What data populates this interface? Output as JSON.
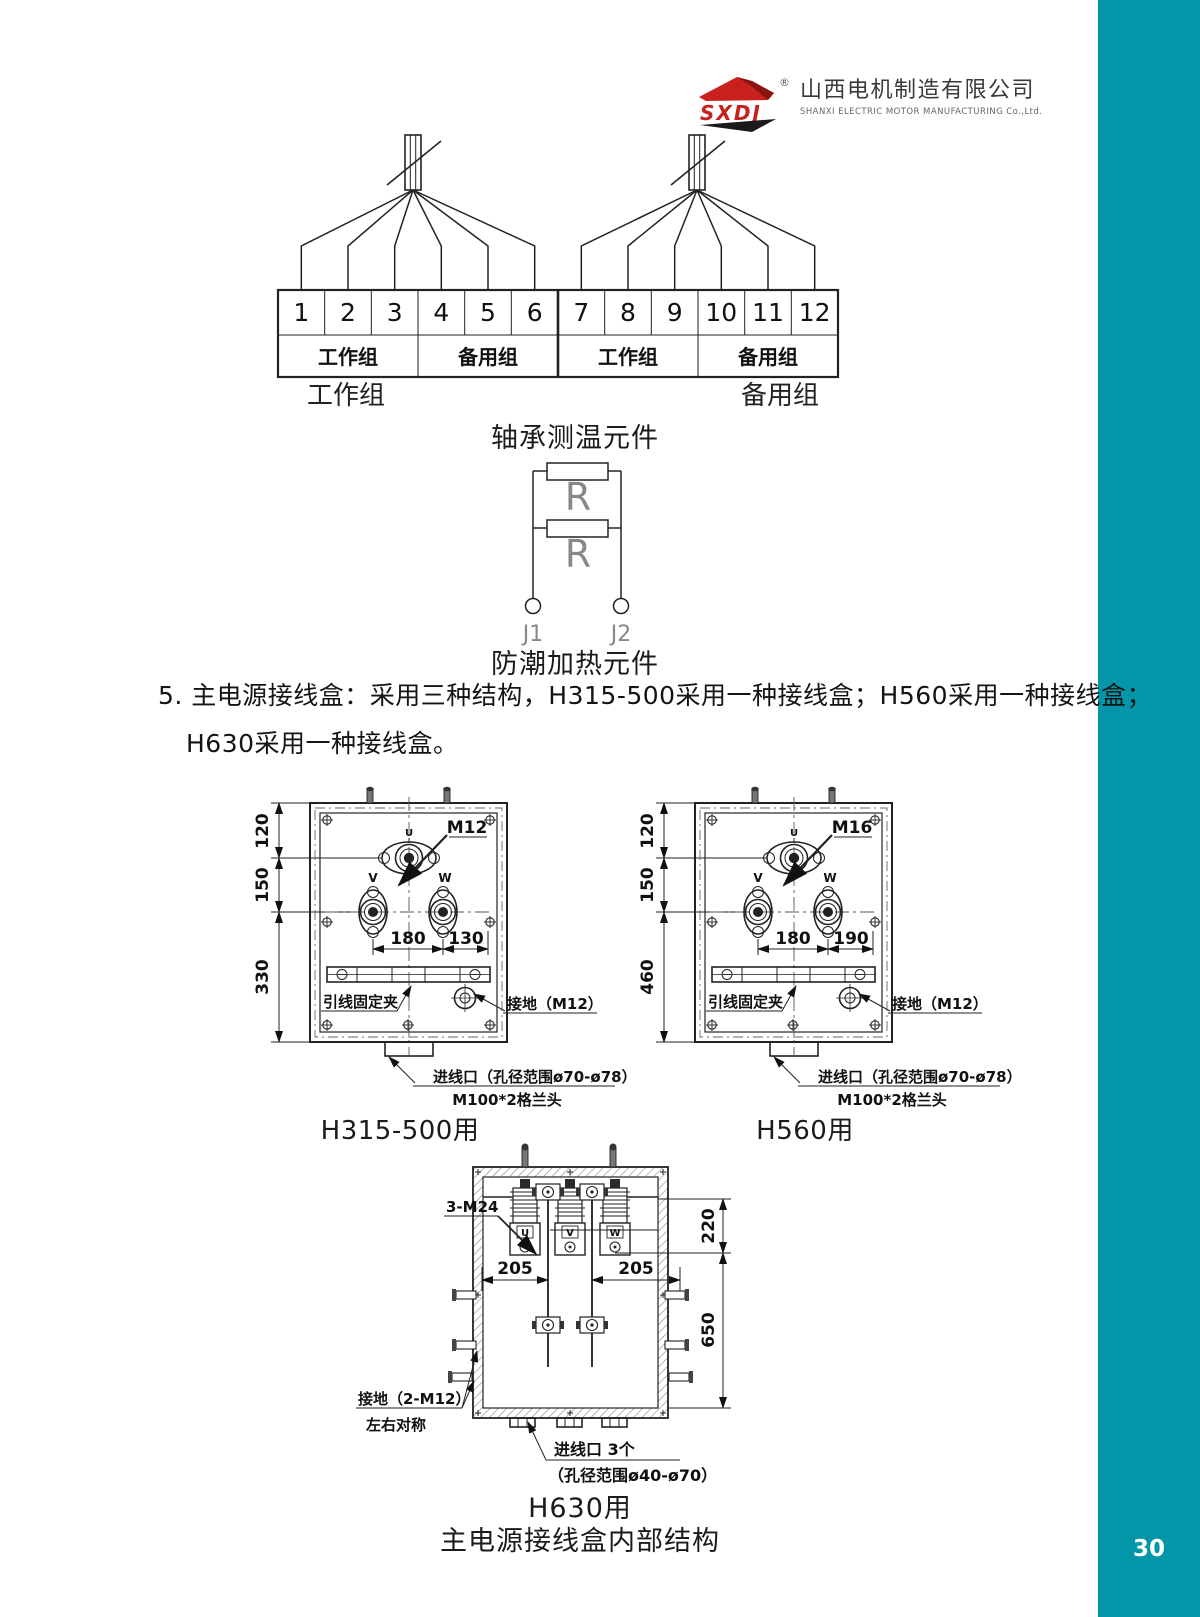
{
  "colors": {
    "accent_teal": "#0396a9",
    "brand_red": "#c8201c"
  },
  "page": {
    "number": "30"
  },
  "logo": {
    "brand": "SXDJ",
    "registered": "®",
    "company_cn": "山西电机制造有限公司",
    "company_en": "SHANXI ELECTRIC MOTOR MANUFACTURING Co.,Ltd."
  },
  "bearing": {
    "terminals": [
      "1",
      "2",
      "3",
      "4",
      "5",
      "6",
      "7",
      "8",
      "9",
      "10",
      "11",
      "12"
    ],
    "groups": [
      "工作组",
      "备用组",
      "工作组",
      "备用组"
    ],
    "left_label": "工作组",
    "right_label": "备用组",
    "caption": "轴承测温元件"
  },
  "heater": {
    "r1": "R",
    "r2": "R",
    "j1": "J1",
    "j2": "J2",
    "caption": "防潮加热元件"
  },
  "section": {
    "line1": "5. 主电源接线盒：采用三种结构，H315-500采用一种接线盒；H560采用一种接线盒；",
    "line2": "H630采用一种接线盒。"
  },
  "box1": {
    "u": "U",
    "v": "V",
    "w": "W",
    "bolt_spec": "M12",
    "dim_top": "120",
    "dim_mid": "150",
    "dim_bottom": "330",
    "dim_span": "180",
    "dim_offset": "130",
    "clamp_label": "引线固定夹",
    "ground_label": "接地（M12）",
    "entry_line1": "进线口（孔径范围ø70-ø78）",
    "entry_line2": "M100*2格兰头",
    "caption": "H315-500用"
  },
  "box2": {
    "u": "U",
    "v": "V",
    "w": "W",
    "bolt_spec": "M16",
    "dim_top": "120",
    "dim_mid": "150",
    "dim_bottom": "460",
    "dim_span": "180",
    "dim_offset": "190",
    "clamp_label": "引线固定夹",
    "ground_label": "接地（M12）",
    "entry_line1": "进线口（孔径范围ø70-ø78）",
    "entry_line2": "M100*2格兰头",
    "caption": "H560用"
  },
  "box3": {
    "u": "U",
    "v": "V",
    "w": "W",
    "bolt_spec": "3-M24",
    "dim_left": "205",
    "dim_right": "205",
    "dim_v_top": "220",
    "dim_v_bottom": "650",
    "ground_line1": "接地（2-M12）",
    "ground_line2": "左右对称",
    "entry_line1": "进线口 3个",
    "entry_line2": "（孔径范围ø40-ø70）",
    "caption": "H630用",
    "subcaption": "主电源接线盒内部结构"
  }
}
